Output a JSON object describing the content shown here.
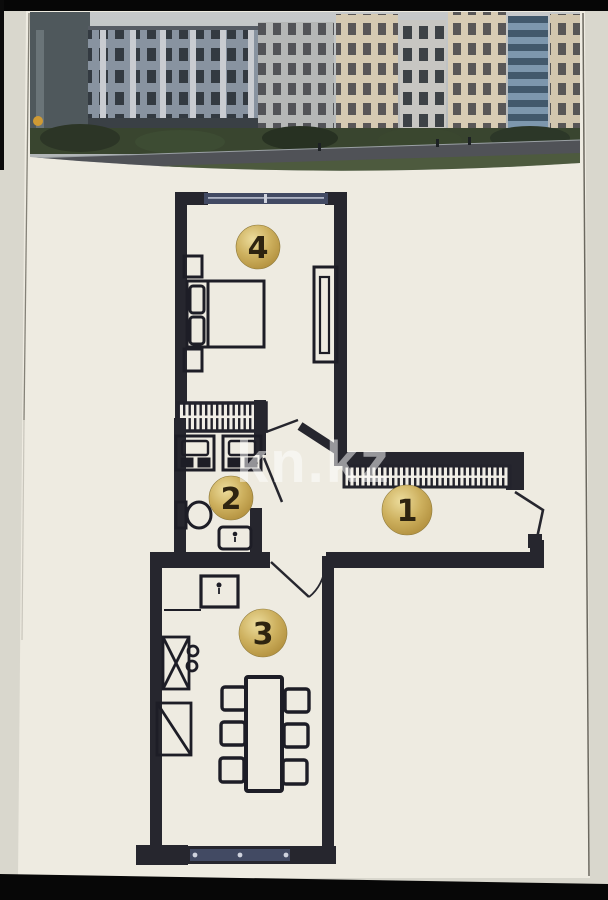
{
  "watermark": {
    "text": "kn.kz"
  },
  "floor_plan": {
    "markers": [
      {
        "number": "1"
      },
      {
        "number": "2"
      },
      {
        "number": "3"
      },
      {
        "number": "4"
      }
    ],
    "colors": {
      "wall": "#26262e",
      "window_glass": "#424a63",
      "hatch_line": "#23232c",
      "marker_gold": "#c9ab56",
      "marker_number": "#2e2410",
      "paper": "#eeebe1"
    }
  },
  "photo": {
    "colors": {
      "sky": "#bfc2c3",
      "building_blue_gray": "#8893a0",
      "building_cream": "#d6cab2",
      "building_glass_blue": "#7d97ad",
      "greenery": "#39452f",
      "road": "#505257"
    }
  }
}
